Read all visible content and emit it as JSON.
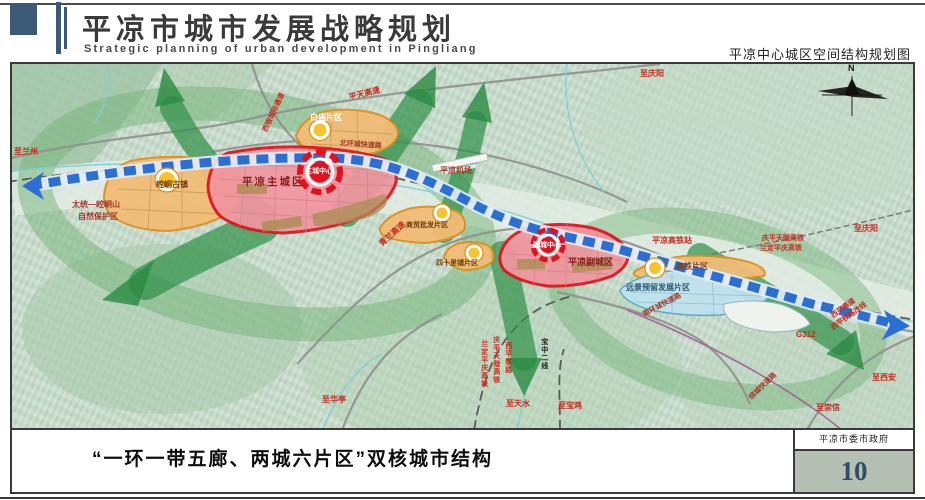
{
  "header": {
    "title": "平凉市城市发展战略规划",
    "subtitle": "Strategic planning of urban development in Pingliang",
    "map_title": "平凉中心城区空间结构规划图"
  },
  "map": {
    "compass": "N",
    "labels": {
      "to_lanzhou": "至兰州",
      "xiyin_corridor": "西银城际通道",
      "pingtian_expwy": "平天高速",
      "to_qingyang_top": "至庆阳",
      "north_ring_road": "北环城快速路",
      "baimiao_district": "白庙片区",
      "airport": "平凉机场",
      "main_city_center": "主城中心",
      "main_city": "平凉主城区",
      "kongtong_town": "崆峒古镇",
      "nature_reserve_1": "太统—崆峒山",
      "nature_reserve_2": "自然保护区",
      "qinglan_expwy": "青兰高速",
      "trade_district": "商贸批发片区",
      "sishilipu_district": "四十里铺片区",
      "vice_city_center": "副城中心",
      "vice_city": "平凉副城区",
      "hsr_station": "平凉高铁站",
      "hsr_line_1": "庆平天陇高铁",
      "hsr_line_2": "兰定平庆高铁",
      "to_qingyang_right": "至庆阳",
      "hsr_district": "高铁片区",
      "reserve_district": "远景预留发展片区",
      "south_ring_road": "南环城快速路",
      "g312": "G312",
      "xiping_expwy": "西平高速",
      "xiping_rail_realign": "西平铁路改线",
      "to_xian": "至西安",
      "to_chongxin": "至崇信",
      "ring_expressway": "绕城快速路",
      "rail_v1": "兰定平庆高铁",
      "rail_v2": "庆平天陇高铁",
      "rail_v3": "西平铁路",
      "rail_v4": "宝中二线",
      "to_tianshui": "至天水",
      "to_baoji": "至宝鸡",
      "to_huating": "至华亭"
    }
  },
  "footer": {
    "caption": "“一环一带五廊、两城六片区”双核城市结构",
    "agency": "平凉市委市政府",
    "page": "10"
  },
  "colors": {
    "header_blue": "#3c5a77",
    "city_red": "#e1111e",
    "zone_orange": "#e8951f",
    "corridor_green": "#2f9048",
    "axis_blue": "#2c6fd4",
    "reserve_cyan": "#bfe2ee",
    "page_number_blue": "#2e4d66"
  }
}
